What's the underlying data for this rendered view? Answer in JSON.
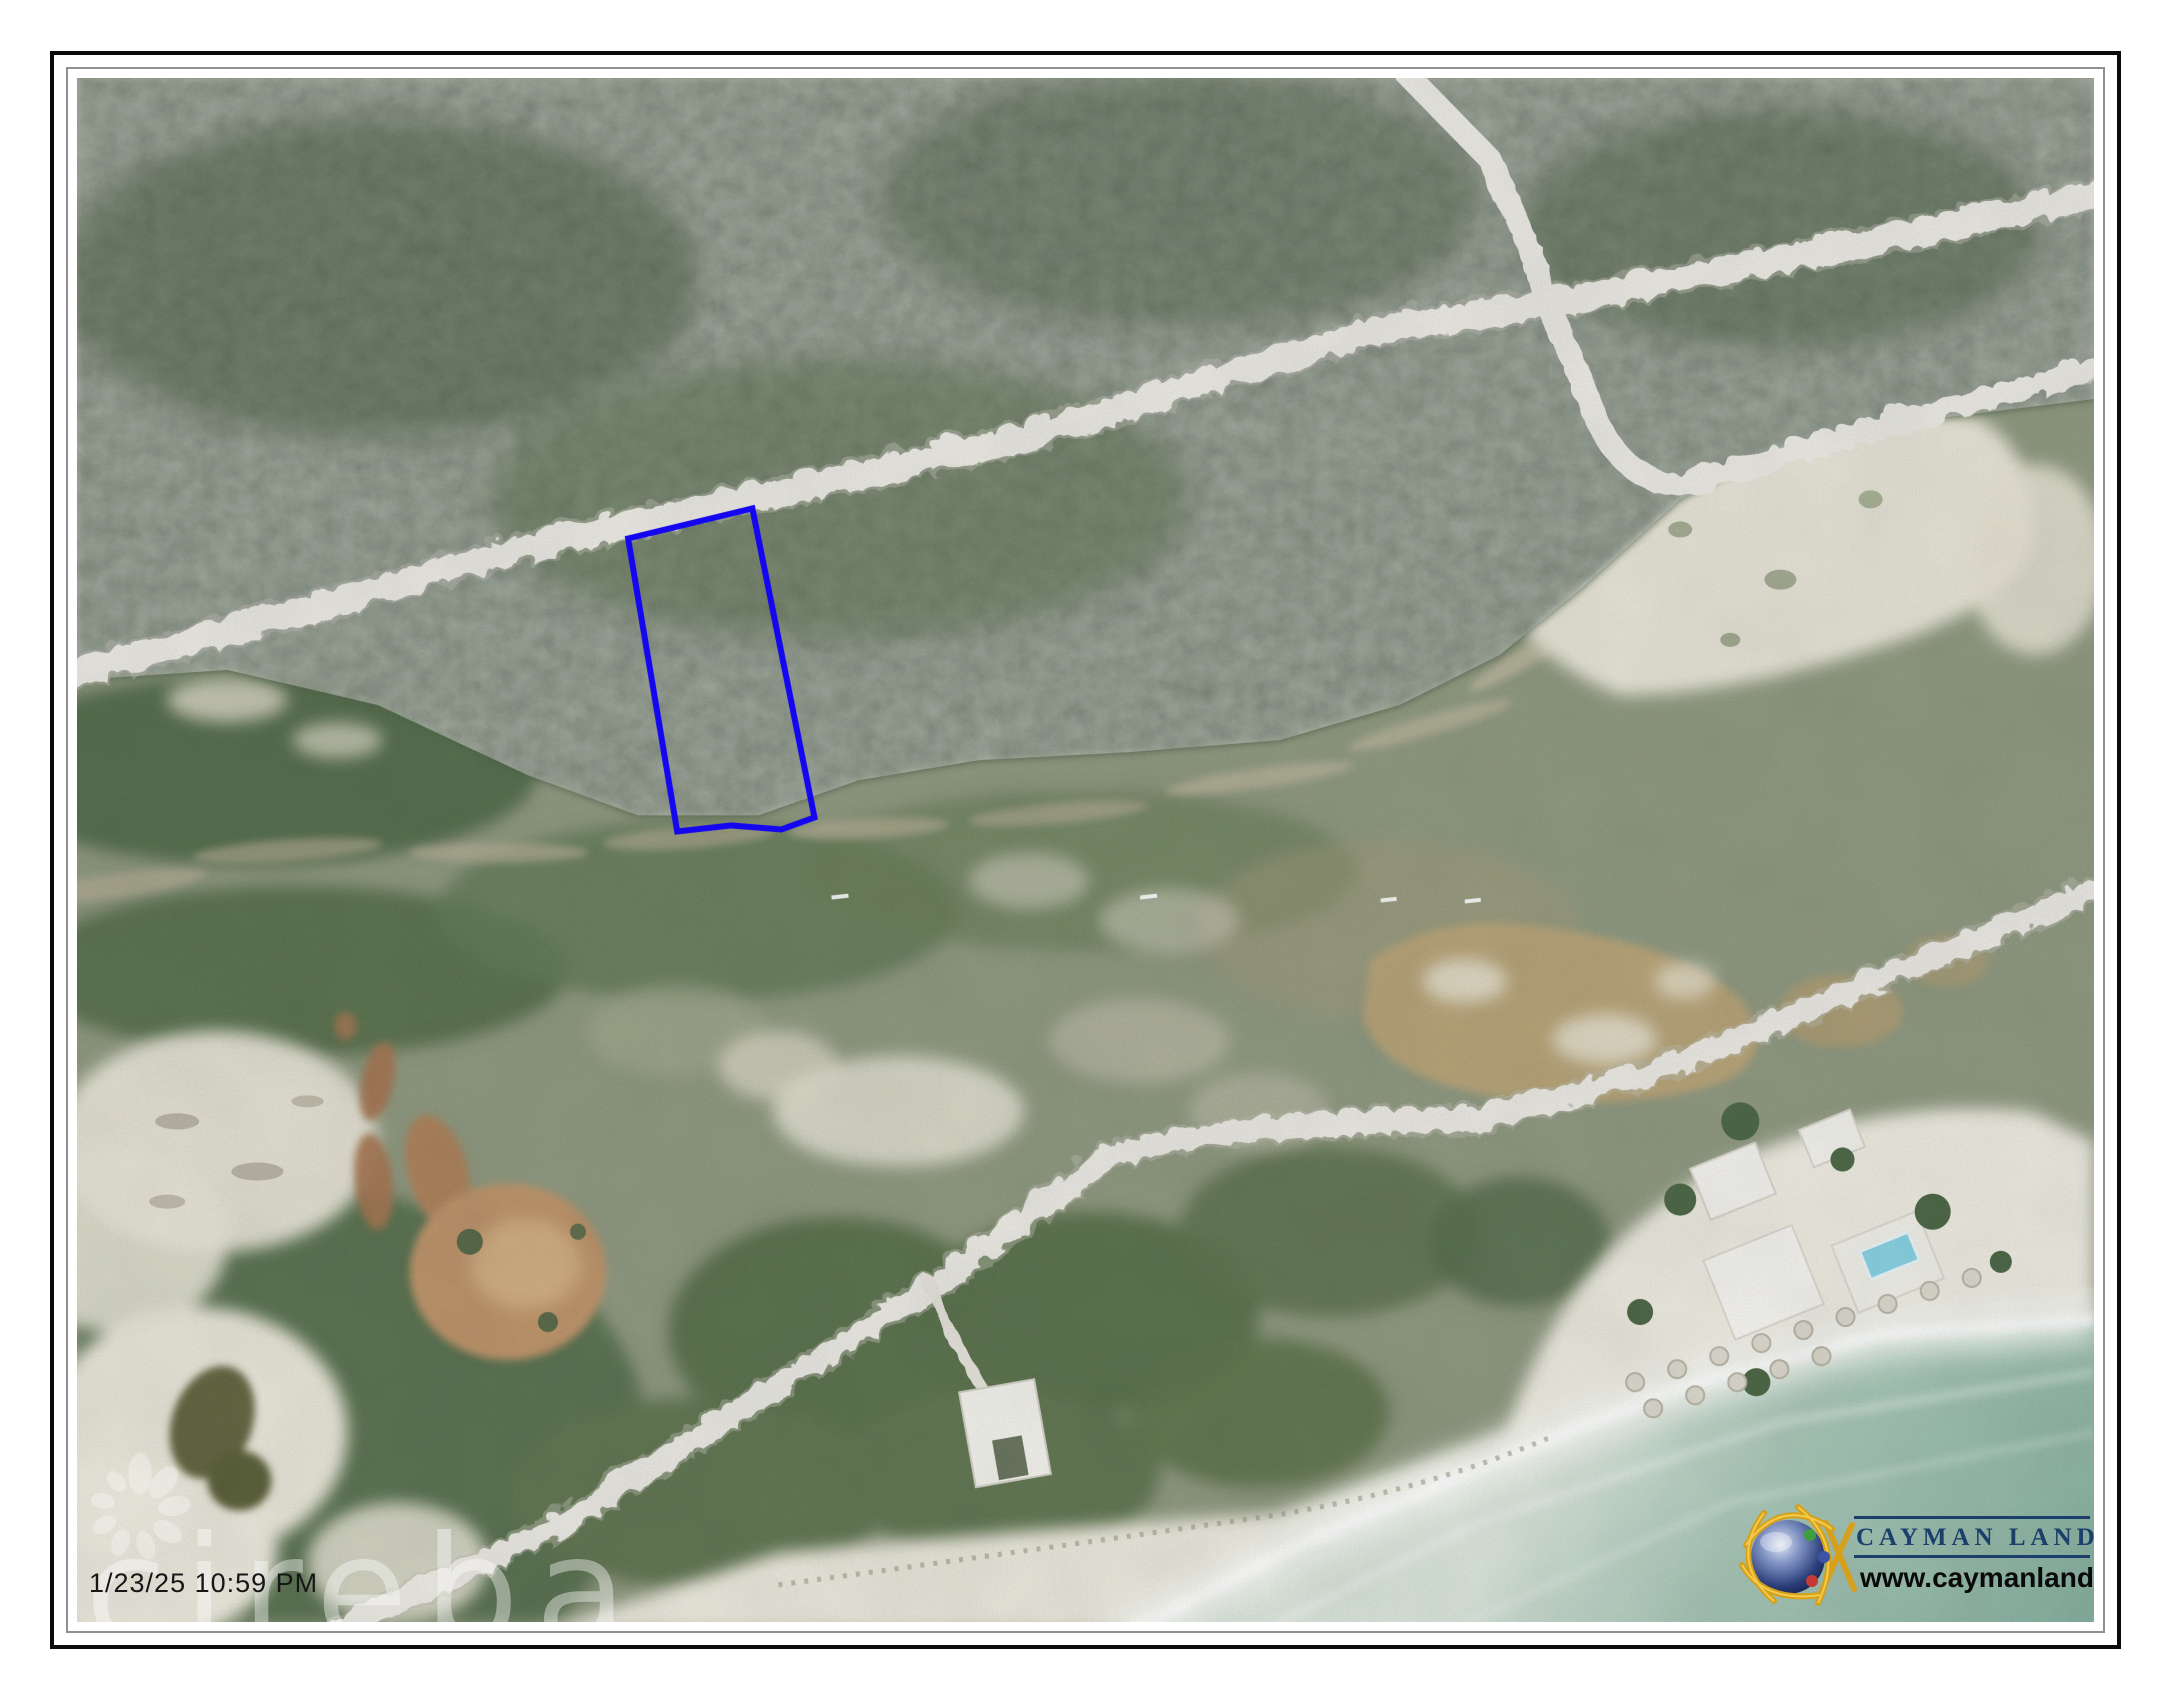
{
  "document": {
    "kind": "aerial-parcel-map-printout",
    "timestamp": "1/23/25 10:59 PM",
    "watermark_text": "cireba",
    "watermark_icon": "cireba-flower-icon"
  },
  "branding": {
    "logo_icon": "globe-icon",
    "name": "CAYMAN LAND INFO",
    "website": "www.caymanlandinfo.ky",
    "name_color": "#1c3e6b"
  },
  "map": {
    "parcel_outline_color": "#1406f0",
    "visible_features": [
      "dense forest",
      "dirt roads",
      "four-way road junction",
      "blue parcel outline",
      "rocky bluff line",
      "white sand patches",
      "tan ponds",
      "dark pond",
      "brown lagoon",
      "coastal road",
      "driveway",
      "houses",
      "beach resort with pool",
      "beach umbrellas",
      "white sand beach",
      "surf foam",
      "turquoise sea"
    ],
    "palette": {
      "forest": "#42563a",
      "scrub": "#879277",
      "road": "#ebe9e2",
      "sand": "#ece9dc",
      "lagoon_tan": "#b29d6e",
      "pond_tan": "#b98c5e",
      "pond_dark": "#565a30",
      "sea": "#7fab99",
      "foam": "#f5f9f3"
    }
  }
}
